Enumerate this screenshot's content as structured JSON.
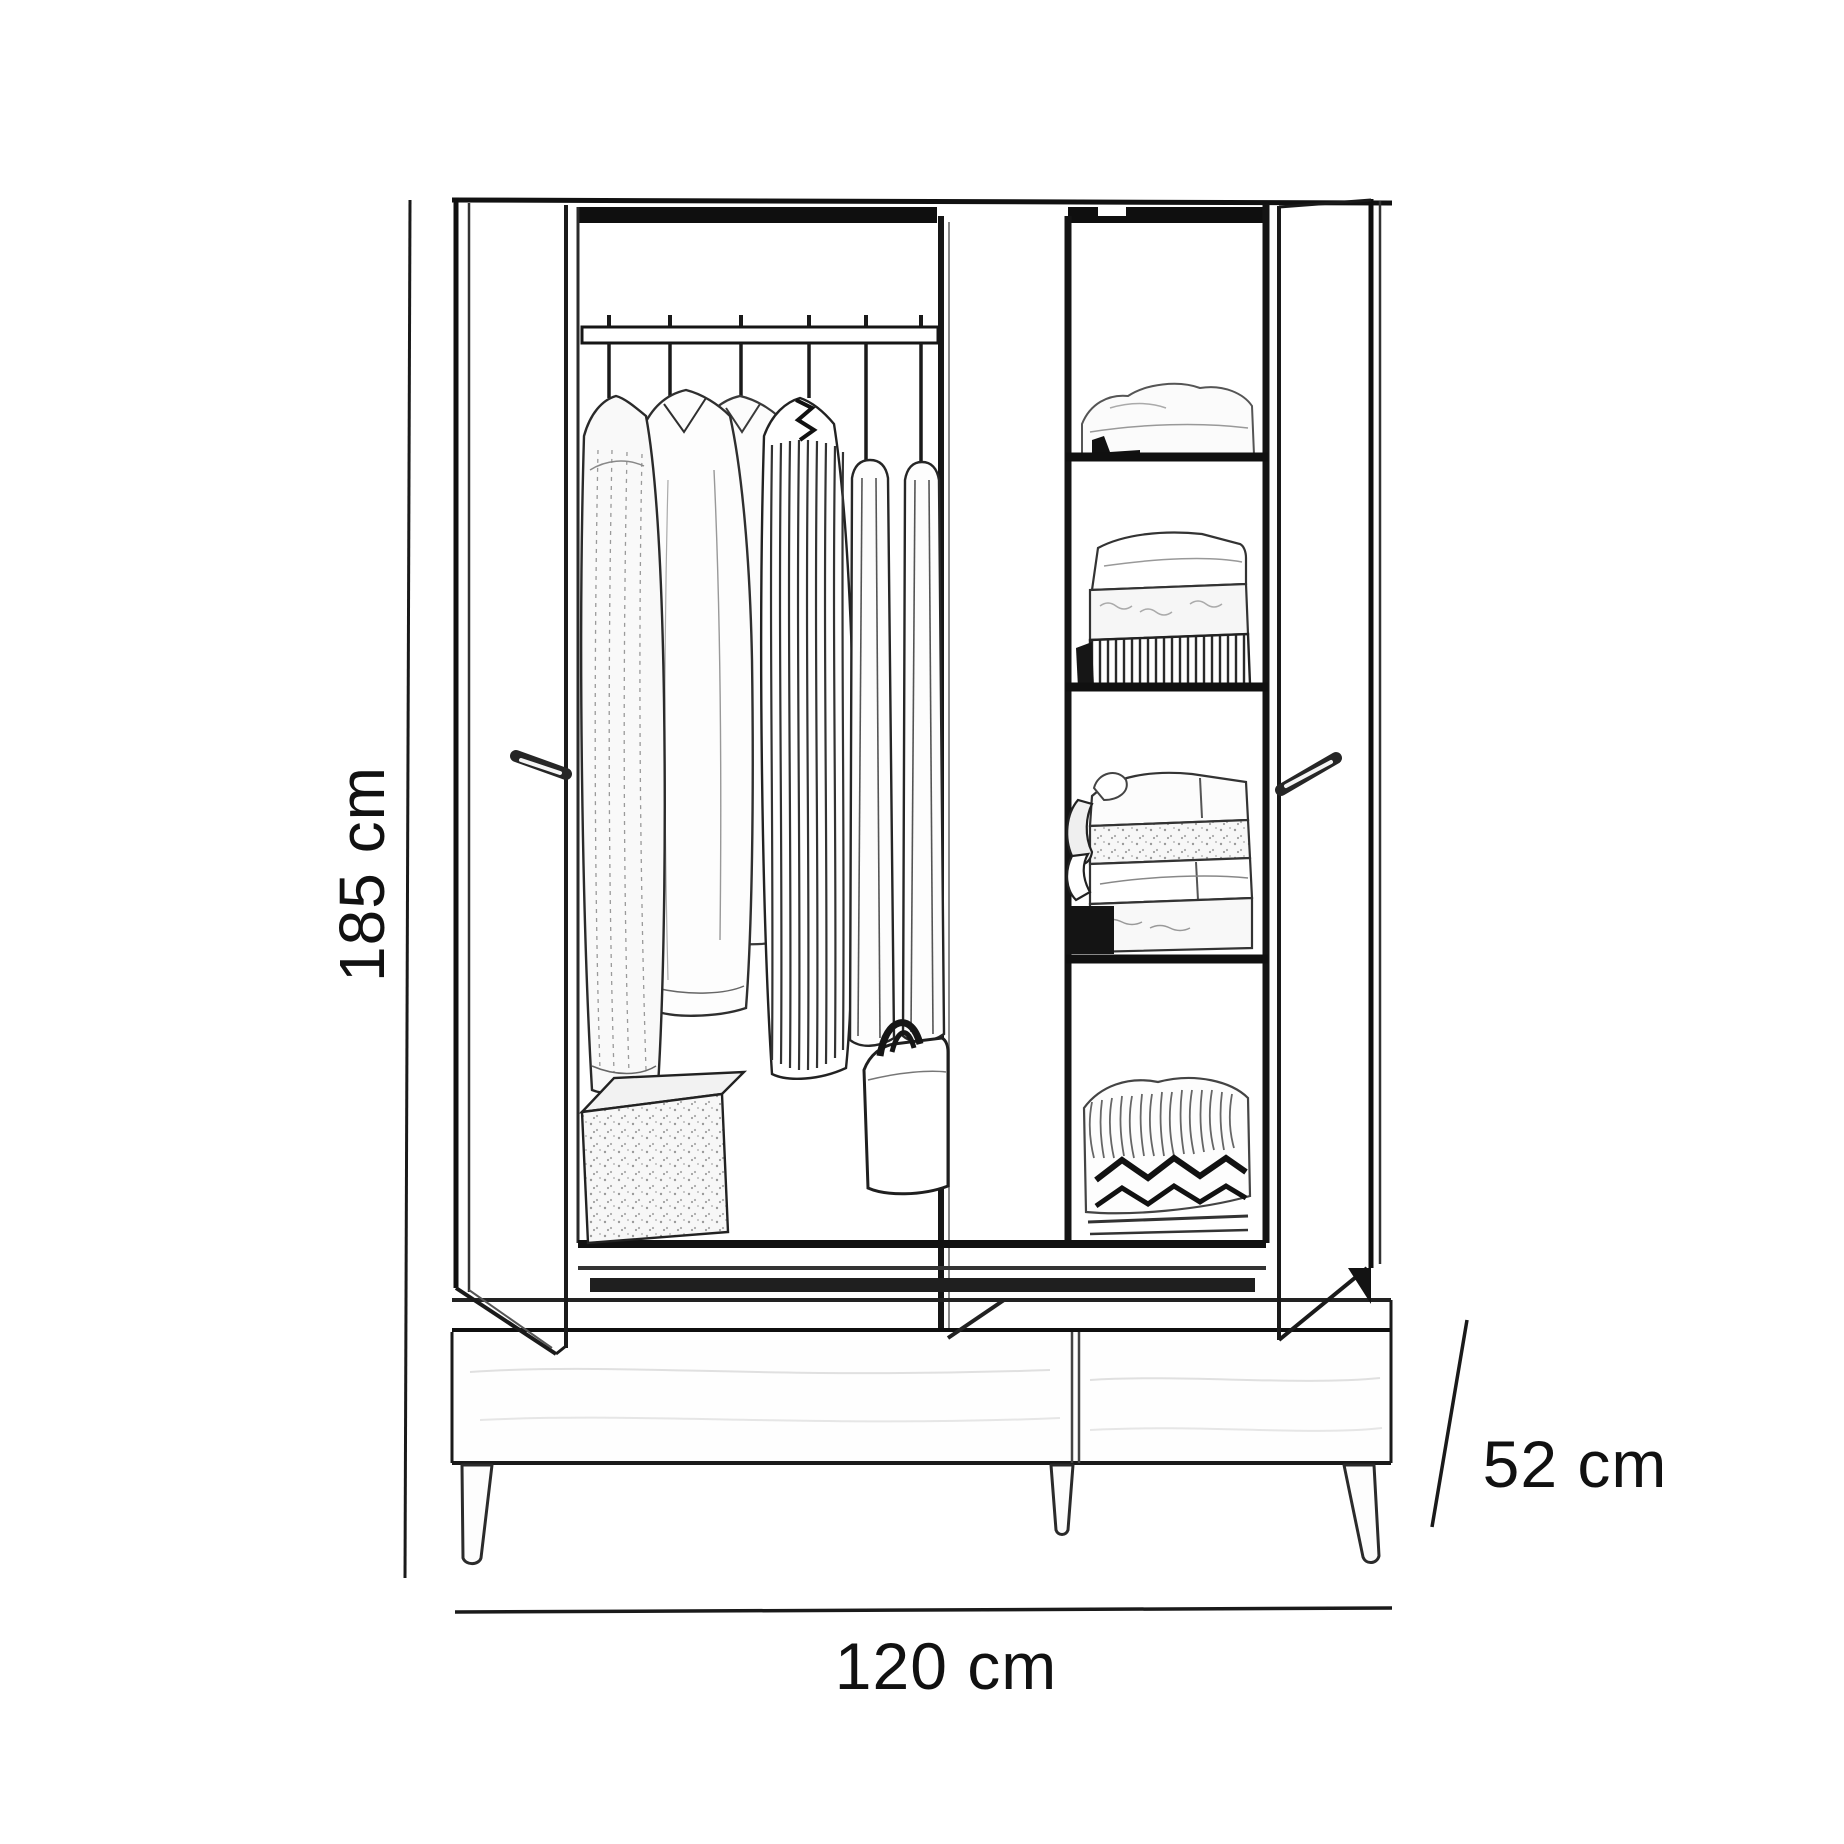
{
  "page": {
    "background_color": "#ffffff",
    "line_color": "#1a1a1a",
    "text_color": "#111111"
  },
  "diagram": {
    "type": "product-dimension-drawing",
    "subject": "wardrobe sketch with open doors, hanging clothes, shelves, two drawers and tapered legs",
    "dimensions": {
      "height_label": "185 cm",
      "width_label": "120 cm",
      "depth_label": "52 cm"
    }
  }
}
